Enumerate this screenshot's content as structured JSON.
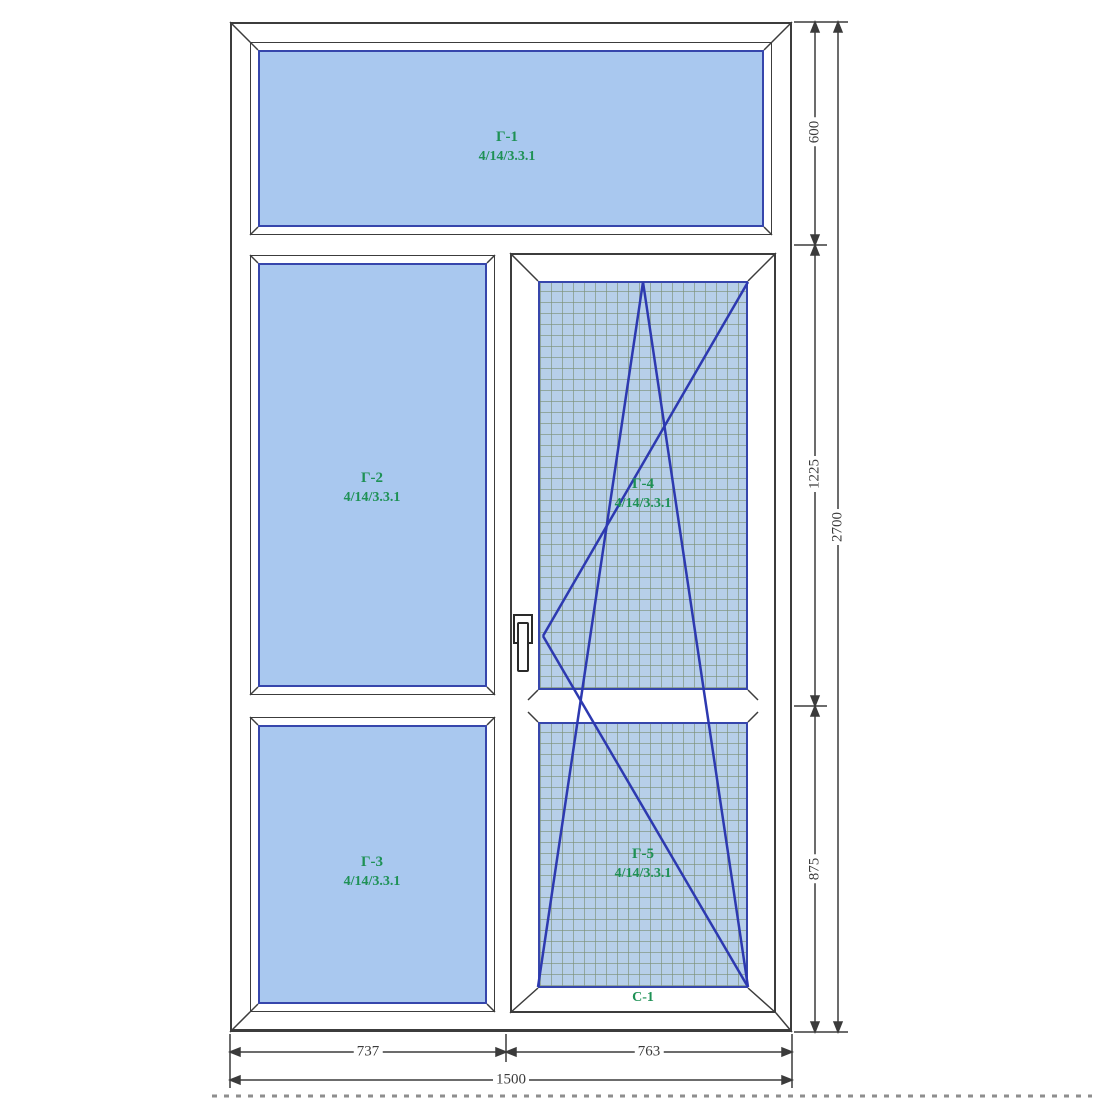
{
  "panels": {
    "g1": {
      "name": "Г-1",
      "formula": "4/14/3.3.1"
    },
    "g2": {
      "name": "Г-2",
      "formula": "4/14/3.3.1"
    },
    "g3": {
      "name": "Г-3",
      "formula": "4/14/3.3.1"
    },
    "g4": {
      "name": "Г-4",
      "formula": "4/14/3.3.1"
    },
    "g5": {
      "name": "Г-5",
      "formula": "4/14/3.3.1"
    }
  },
  "sash": {
    "label": "С-1"
  },
  "dimensions": {
    "height_segments": [
      "600",
      "1225",
      "875"
    ],
    "total_height": "2700",
    "width_segments": [
      "737",
      "763"
    ],
    "total_width": "1500"
  },
  "colors": {
    "glass": "#a9c8ef",
    "mesh": "#b7cfe9",
    "glass_border": "#3646ac",
    "frame_line": "#3c3c3c",
    "opening_symbol": "#2d39b0",
    "label_green": "#1e9155"
  }
}
